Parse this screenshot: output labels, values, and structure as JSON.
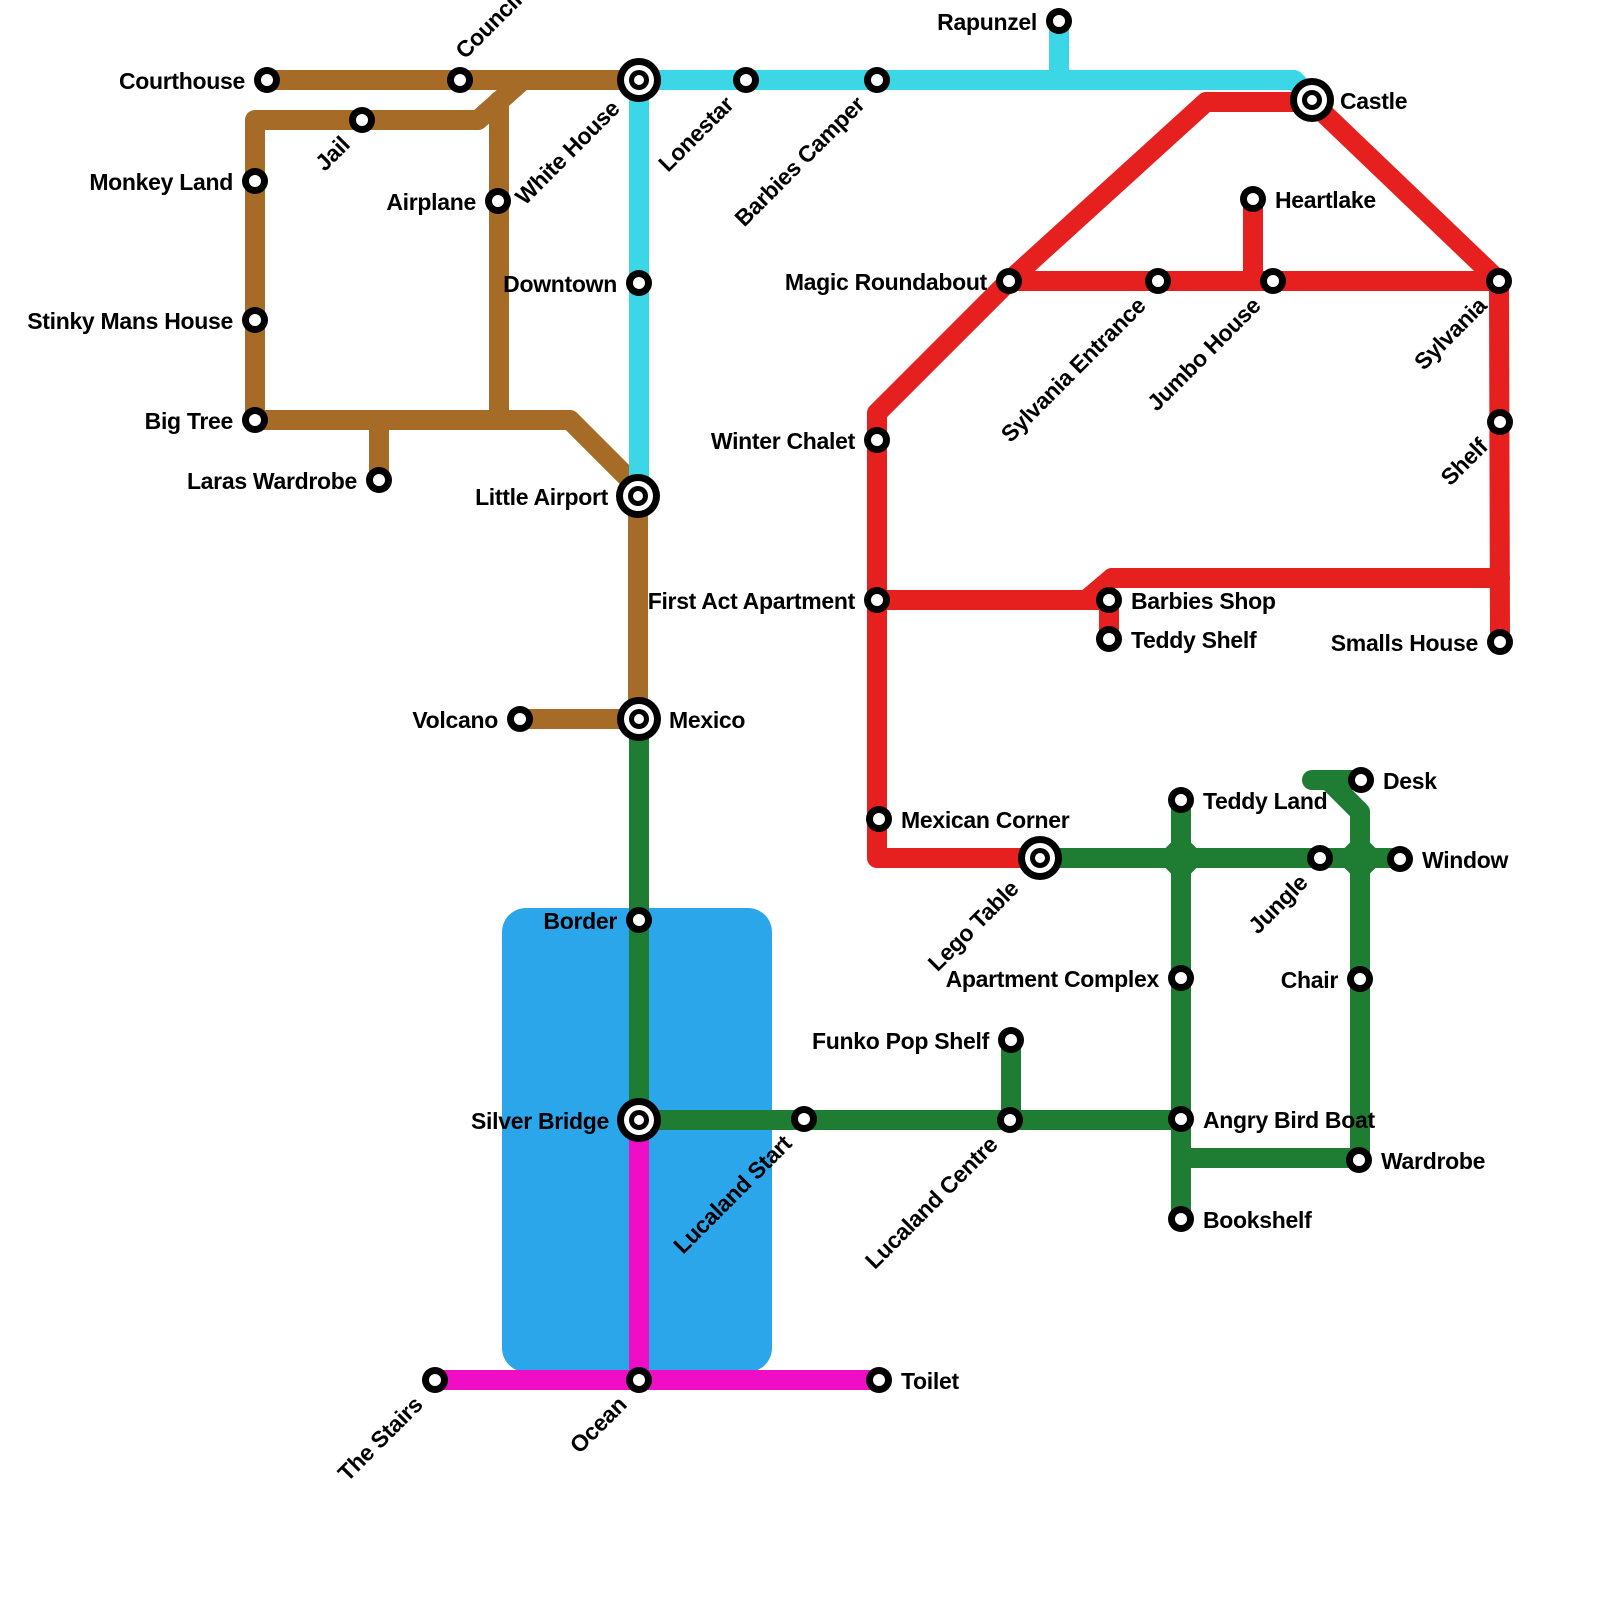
{
  "map": {
    "background_color": "#ffffff",
    "line_width": 20,
    "label_color": "#000000",
    "water": {
      "name": "river-lake",
      "x": 502,
      "y": 908,
      "width": 270,
      "height": 464,
      "corner_radius": 24,
      "color": "#2BA6EA"
    },
    "station_style": {
      "normal": {
        "r_outer": 13,
        "r_inner": 6
      },
      "interchange": {
        "r1": 22,
        "r2": 15,
        "r3": 10,
        "r4": 5
      }
    },
    "label_presets": {
      "left": {
        "anchor": "end",
        "rot": 0,
        "dx": -22,
        "dy": 9
      },
      "right": {
        "anchor": "start",
        "rot": 0,
        "dx": 22,
        "dy": 9
      },
      "diag": {
        "anchor": "end",
        "rot": -45,
        "dx": -11,
        "dy": 26
      },
      "diag-up": {
        "anchor": "start",
        "rot": -45,
        "dx": 5,
        "dy": -20
      }
    },
    "lines": [
      {
        "id": "brown",
        "color": "#A76B28",
        "paths": [
          [
            [
              267,
              80
            ],
            [
              639,
              80
            ]
          ],
          [
            [
              523,
              80
            ],
            [
              478,
              120
            ],
            [
              255,
              120
            ],
            [
              255,
              420
            ],
            [
              570,
              420
            ],
            [
              638,
              488
            ],
            [
              638,
              719
            ]
          ],
          [
            [
              499,
              101
            ],
            [
              499,
              420
            ]
          ],
          [
            [
              379,
              422
            ],
            [
              379,
              480
            ]
          ],
          [
            [
              520,
              719
            ],
            [
              638,
              719
            ]
          ]
        ]
      },
      {
        "id": "cyan",
        "color": "#3CD7E6",
        "paths": [
          [
            [
              639,
              80
            ],
            [
              1294,
              80
            ],
            [
              1312,
              98
            ]
          ],
          [
            [
              1059,
              24
            ],
            [
              1059,
              80
            ]
          ],
          [
            [
              639,
              80
            ],
            [
              639,
              496
            ]
          ]
        ]
      },
      {
        "id": "red",
        "color": "#E6201E",
        "paths": [
          [
            [
              1009,
              281
            ],
            [
              1206,
              102
            ],
            [
              1312,
              102
            ],
            [
              1499,
              281
            ],
            [
              1500,
              642
            ]
          ],
          [
            [
              1009,
              281
            ],
            [
              1490,
              281
            ]
          ],
          [
            [
              1253,
              202
            ],
            [
              1253,
              281
            ]
          ],
          [
            [
              1009,
              281
            ],
            [
              877,
              413
            ],
            [
              877,
              858
            ],
            [
              1040,
              858
            ]
          ],
          [
            [
              1112,
              578
            ],
            [
              1500,
              578
            ]
          ],
          [
            [
              1086,
              600
            ],
            [
              1112,
              578
            ]
          ],
          [
            [
              877,
              600
            ],
            [
              1109,
              600
            ]
          ],
          [
            [
              1109,
              600
            ],
            [
              1109,
              639
            ]
          ]
        ]
      },
      {
        "id": "green",
        "color": "#1E7D33",
        "paths": [
          [
            [
              639,
              719
            ],
            [
              639,
              1120
            ],
            [
              1181,
              1120
            ]
          ],
          [
            [
              1011,
              1040
            ],
            [
              1011,
              1120
            ]
          ],
          [
            [
              1040,
              858
            ],
            [
              1400,
              858
            ]
          ],
          [
            [
              1181,
              800
            ],
            [
              1181,
              1219
            ]
          ],
          [
            [
              1312,
              780
            ],
            [
              1361,
              780
            ]
          ],
          [
            [
              1332,
              784
            ],
            [
              1360,
              812
            ],
            [
              1360,
              1160
            ]
          ],
          [
            [
              1181,
              1158
            ],
            [
              1359,
              1158
            ]
          ]
        ]
      },
      {
        "id": "magenta",
        "color": "#EF0DC6",
        "paths": [
          [
            [
              639,
              1120
            ],
            [
              639,
              1380
            ]
          ],
          [
            [
              435,
              1380
            ],
            [
              879,
              1380
            ]
          ]
        ]
      }
    ],
    "junction_diamonds": [
      {
        "line": "green",
        "x": 1181,
        "y": 858,
        "size": 36
      },
      {
        "line": "green",
        "x": 1360,
        "y": 858,
        "size": 36
      }
    ],
    "stations": [
      {
        "name": "Courthouse",
        "x": 267,
        "y": 80,
        "type": "normal",
        "label": {
          "preset": "left"
        }
      },
      {
        "name": "Council",
        "x": 460,
        "y": 80,
        "type": "normal",
        "label": {
          "preset": "diag-up"
        }
      },
      {
        "name": "White House",
        "x": 639,
        "y": 80,
        "type": "interchange",
        "label": {
          "preset": "diag",
          "dx": -18,
          "dy": 30
        }
      },
      {
        "name": "Jail",
        "x": 362,
        "y": 120,
        "type": "normal",
        "label": {
          "preset": "diag"
        }
      },
      {
        "name": "Monkey Land",
        "x": 255,
        "y": 181,
        "type": "normal",
        "label": {
          "preset": "left"
        }
      },
      {
        "name": "Airplane",
        "x": 498,
        "y": 201,
        "type": "normal",
        "label": {
          "preset": "left"
        }
      },
      {
        "name": "Stinky Mans House",
        "x": 255,
        "y": 320,
        "type": "normal",
        "label": {
          "preset": "left"
        }
      },
      {
        "name": "Big Tree",
        "x": 255,
        "y": 420,
        "type": "normal",
        "label": {
          "preset": "left"
        }
      },
      {
        "name": "Laras Wardrobe",
        "x": 379,
        "y": 480,
        "type": "normal",
        "label": {
          "preset": "left"
        }
      },
      {
        "name": "Little Airport",
        "x": 638,
        "y": 496,
        "type": "interchange",
        "label": {
          "preset": "left",
          "dx": -30
        }
      },
      {
        "name": "Downtown",
        "x": 639,
        "y": 283,
        "type": "normal",
        "label": {
          "preset": "left"
        }
      },
      {
        "name": "Lonestar",
        "x": 746,
        "y": 80,
        "type": "normal",
        "label": {
          "preset": "diag"
        }
      },
      {
        "name": "Barbies Camper",
        "x": 877,
        "y": 80,
        "type": "normal",
        "label": {
          "preset": "diag"
        }
      },
      {
        "name": "Rapunzel",
        "x": 1059,
        "y": 21,
        "type": "normal",
        "label": {
          "preset": "left"
        }
      },
      {
        "name": "Castle",
        "x": 1312,
        "y": 100,
        "type": "interchange",
        "label": {
          "preset": "right",
          "dx": 28
        }
      },
      {
        "name": "Heartlake",
        "x": 1253,
        "y": 199,
        "type": "normal",
        "label": {
          "preset": "right"
        }
      },
      {
        "name": "Magic Roundabout",
        "x": 1009,
        "y": 281,
        "type": "normal",
        "label": {
          "preset": "left"
        }
      },
      {
        "name": "Sylvania Entrance",
        "x": 1158,
        "y": 281,
        "type": "normal",
        "label": {
          "preset": "diag"
        }
      },
      {
        "name": "Jumbo House",
        "x": 1273,
        "y": 281,
        "type": "normal",
        "label": {
          "preset": "diag"
        }
      },
      {
        "name": "Sylvania",
        "x": 1499,
        "y": 281,
        "type": "normal",
        "label": {
          "preset": "diag"
        }
      },
      {
        "name": "Shelf",
        "x": 1500,
        "y": 422,
        "type": "normal",
        "label": {
          "preset": "diag"
        }
      },
      {
        "name": "Winter Chalet",
        "x": 877,
        "y": 440,
        "type": "normal",
        "label": {
          "preset": "left"
        }
      },
      {
        "name": "First Act Apartment",
        "x": 877,
        "y": 600,
        "type": "normal",
        "label": {
          "preset": "left"
        }
      },
      {
        "name": "Barbies Shop",
        "x": 1109,
        "y": 600,
        "type": "normal",
        "label": {
          "preset": "right"
        }
      },
      {
        "name": "Teddy Shelf",
        "x": 1109,
        "y": 639,
        "type": "normal",
        "label": {
          "preset": "right"
        }
      },
      {
        "name": "Smalls House",
        "x": 1500,
        "y": 642,
        "type": "normal",
        "label": {
          "preset": "left"
        }
      },
      {
        "name": "Volcano",
        "x": 520,
        "y": 719,
        "type": "normal",
        "label": {
          "preset": "left"
        }
      },
      {
        "name": "Mexico",
        "x": 639,
        "y": 719,
        "type": "interchange",
        "label": {
          "preset": "right",
          "dx": 30
        }
      },
      {
        "name": "Mexican Corner",
        "x": 879,
        "y": 819,
        "type": "normal",
        "label": {
          "preset": "right"
        }
      },
      {
        "name": "Lego Table",
        "x": 1040,
        "y": 858,
        "type": "interchange",
        "label": {
          "preset": "diag",
          "dx": -20,
          "dy": 32
        }
      },
      {
        "name": "Teddy Land",
        "x": 1181,
        "y": 800,
        "type": "normal",
        "label": {
          "preset": "right"
        }
      },
      {
        "name": "Desk",
        "x": 1361,
        "y": 780,
        "type": "normal",
        "label": {
          "preset": "right"
        }
      },
      {
        "name": "Window",
        "x": 1400,
        "y": 859,
        "type": "normal",
        "label": {
          "preset": "right"
        }
      },
      {
        "name": "Jungle",
        "x": 1320,
        "y": 858,
        "type": "normal",
        "label": {
          "preset": "diag"
        }
      },
      {
        "name": "Chair",
        "x": 1360,
        "y": 979,
        "type": "normal",
        "label": {
          "preset": "left"
        }
      },
      {
        "name": "Apartment Complex",
        "x": 1181,
        "y": 978,
        "type": "normal",
        "label": {
          "preset": "left"
        }
      },
      {
        "name": "Border",
        "x": 639,
        "y": 920,
        "type": "normal",
        "label": {
          "preset": "left"
        }
      },
      {
        "name": "Funko Pop Shelf",
        "x": 1011,
        "y": 1040,
        "type": "normal",
        "label": {
          "preset": "left"
        }
      },
      {
        "name": "Silver Bridge",
        "x": 639,
        "y": 1120,
        "type": "interchange",
        "label": {
          "preset": "left",
          "dx": -30
        }
      },
      {
        "name": "Lucaland Start",
        "x": 804,
        "y": 1119,
        "type": "normal",
        "label": {
          "preset": "diag"
        }
      },
      {
        "name": "Lucaland Centre",
        "x": 1010,
        "y": 1120,
        "type": "normal",
        "label": {
          "preset": "diag"
        }
      },
      {
        "name": "Angry Bird Boat",
        "x": 1181,
        "y": 1119,
        "type": "normal",
        "label": {
          "preset": "right"
        }
      },
      {
        "name": "Wardrobe",
        "x": 1359,
        "y": 1160,
        "type": "normal",
        "label": {
          "preset": "right"
        }
      },
      {
        "name": "Bookshelf",
        "x": 1181,
        "y": 1219,
        "type": "normal",
        "label": {
          "preset": "right"
        }
      },
      {
        "name": "The Stairs",
        "x": 435,
        "y": 1380,
        "type": "normal",
        "label": {
          "preset": "diag"
        }
      },
      {
        "name": "Ocean",
        "x": 639,
        "y": 1380,
        "type": "normal",
        "label": {
          "preset": "diag"
        }
      },
      {
        "name": "Toilet",
        "x": 879,
        "y": 1380,
        "type": "normal",
        "label": {
          "preset": "right"
        }
      }
    ]
  }
}
